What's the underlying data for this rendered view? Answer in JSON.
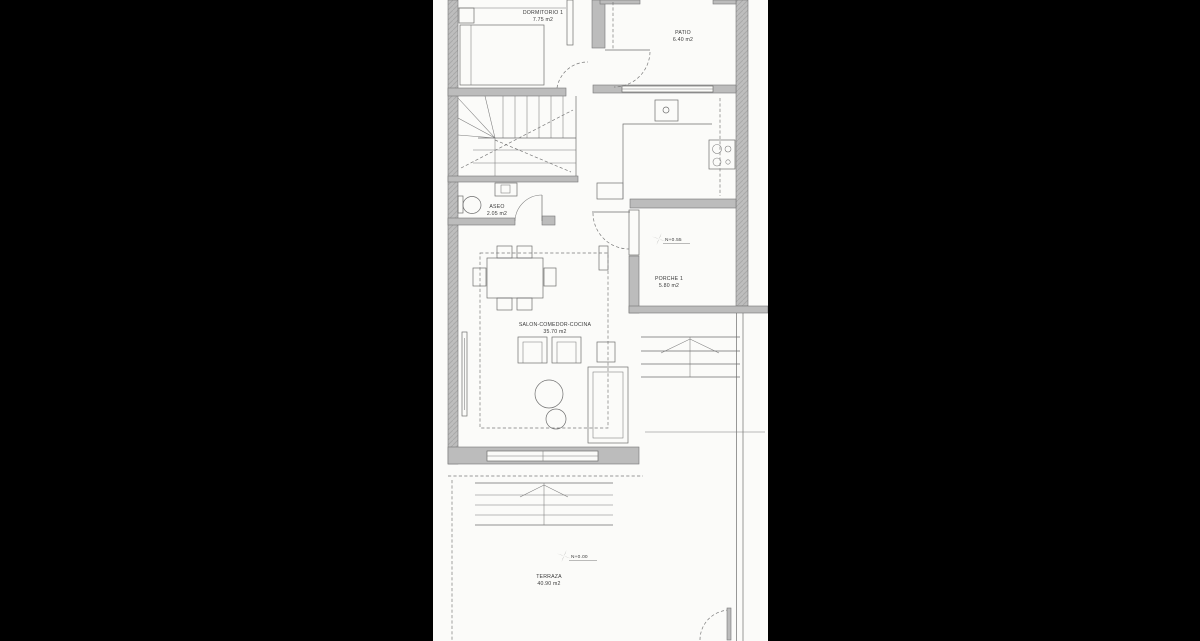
{
  "scene": {
    "background_color": "#000000",
    "paper_color": "#fbfbf9",
    "wall_fill_color": "#bcbcbc",
    "line_color": "#6e6e6e",
    "text_color": "#3a3a3a"
  },
  "plan": {
    "rooms": {
      "dormitorio": {
        "name": "DORMITORIO 1",
        "area": "7.75 m2"
      },
      "patio": {
        "name": "PATIO",
        "area": "6.40 m2"
      },
      "aseo": {
        "name": "ASEO",
        "area": "2.05 m2"
      },
      "salon": {
        "name": "SALON-COMEDOR-COCINA",
        "area": "35.70 m2"
      },
      "porche": {
        "name": "PORCHE 1",
        "area": "5.80 m2"
      },
      "terraza": {
        "name": "TERRAZA",
        "area": "40.90 m2"
      }
    },
    "level_marks": {
      "porche": "N+0.55",
      "terraza": "N+0.00"
    }
  }
}
